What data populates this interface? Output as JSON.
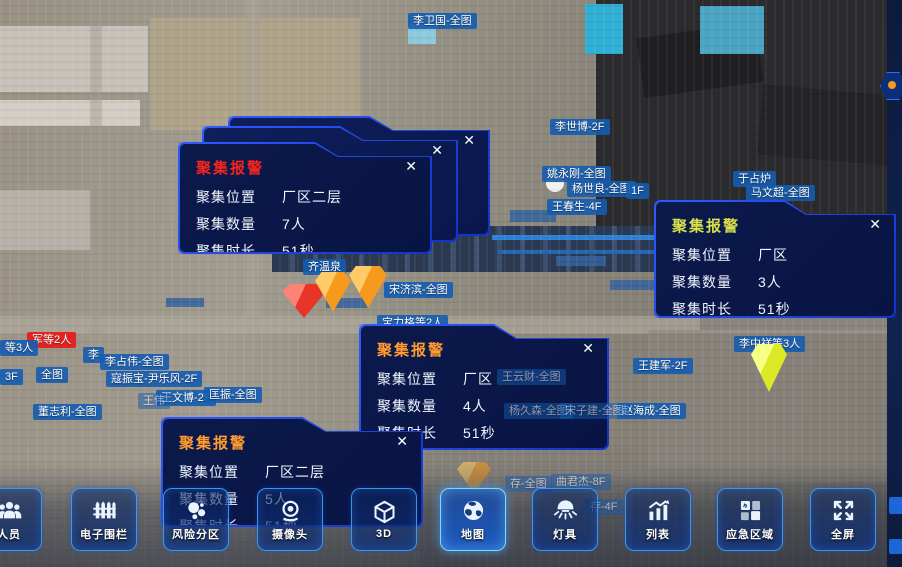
{
  "close_glyph": "✕",
  "colors": {
    "panel_border": "#2d5bff",
    "label_bg": "#155caf",
    "alert_label_bg": "#e41e1e",
    "title_red": "#f5241f",
    "title_orange": "#ff9b2f",
    "title_yellow": "#d7e04a",
    "marker_red": "#e8352a",
    "marker_orange": "#f59a1d",
    "marker_yellow": "#dde926"
  },
  "alarm_panels": [
    {
      "variant": "stack",
      "x": 228,
      "y": 116,
      "w": 262,
      "h": 120,
      "title": "聚集报警",
      "title_color": "#b22a2a",
      "rows": [
        [
          "聚集位置",
          "厂区二层"
        ],
        [
          "聚集数量",
          "5人"
        ],
        [
          "聚集时长",
          "51秒"
        ]
      ]
    },
    {
      "variant": "stack",
      "x": 202,
      "y": 126,
      "w": 256,
      "h": 116,
      "title": "聚集报警",
      "title_color": "#b22a2a",
      "rows": [
        [
          "聚集位置",
          "厂区二层"
        ],
        [
          "聚集数量",
          "5人"
        ],
        [
          "聚集时长",
          "51秒"
        ]
      ]
    },
    {
      "variant": "front",
      "x": 178,
      "y": 142,
      "w": 254,
      "h": 112,
      "title": "聚集报警",
      "title_color": "#f5241f",
      "rows": [
        [
          "聚集位置",
          "厂区二层"
        ],
        [
          "聚集数量",
          "7人"
        ],
        [
          "聚集时长",
          "51秒"
        ]
      ]
    },
    {
      "variant": "front",
      "x": 654,
      "y": 200,
      "w": 242,
      "h": 118,
      "title": "聚集报警",
      "title_color": "#d7e04a",
      "rows": [
        [
          "聚集位置",
          "厂区"
        ],
        [
          "聚集数量",
          "3人"
        ],
        [
          "聚集时长",
          "51秒"
        ]
      ]
    },
    {
      "variant": "front",
      "x": 359,
      "y": 324,
      "w": 250,
      "h": 126,
      "title": "聚集报警",
      "title_color": "#ff9b2f",
      "rows": [
        [
          "聚集位置",
          "厂区"
        ],
        [
          "聚集数量",
          "4人"
        ],
        [
          "聚集时长",
          "51秒"
        ]
      ]
    },
    {
      "variant": "front",
      "x": 161,
      "y": 417,
      "w": 262,
      "h": 110,
      "title": "聚集报警",
      "title_color": "#ff9b2f",
      "rows": [
        [
          "聚集位置",
          "厂区二层"
        ],
        [
          "聚集数量",
          "5人"
        ],
        [
          "聚集时长",
          "51秒"
        ]
      ]
    }
  ],
  "map_labels": [
    {
      "text": "李卫国-全图",
      "x": 408,
      "y": 13
    },
    {
      "text": "李世博-2F",
      "x": 550,
      "y": 119
    },
    {
      "text": "姚永刚-全图",
      "x": 542,
      "y": 166
    },
    {
      "text": "杨世良-全图",
      "x": 567,
      "y": 181
    },
    {
      "text": "1F",
      "x": 626,
      "y": 183
    },
    {
      "text": "王春生-4F",
      "x": 547,
      "y": 199
    },
    {
      "text": "于占炉",
      "x": 733,
      "y": 171
    },
    {
      "text": "马文超-全图",
      "x": 746,
      "y": 185
    },
    {
      "text": "齐温泉",
      "x": 303,
      "y": 259
    },
    {
      "text": "宋济滨-全图",
      "x": 384,
      "y": 282
    },
    {
      "text": "宝力格等2人",
      "x": 377,
      "y": 315
    },
    {
      "text": "军等2人",
      "x": 27,
      "y": 332,
      "variant": "red"
    },
    {
      "text": "等3人",
      "x": 0,
      "y": 340
    },
    {
      "text": "李",
      "x": 83,
      "y": 347
    },
    {
      "text": "李占伟-全图",
      "x": 100,
      "y": 354
    },
    {
      "text": "3F",
      "x": 0,
      "y": 369
    },
    {
      "text": "全图",
      "x": 36,
      "y": 367
    },
    {
      "text": "寇振宝-尹乐风-2F",
      "x": 106,
      "y": 371
    },
    {
      "text": "王伟",
      "x": 138,
      "y": 393,
      "variant": "dim"
    },
    {
      "text": "王文博-2F",
      "x": 156,
      "y": 390
    },
    {
      "text": "匡振-全图",
      "x": 204,
      "y": 387
    },
    {
      "text": "董志利-全图",
      "x": 33,
      "y": 404
    },
    {
      "text": "王建军-2F",
      "x": 633,
      "y": 358
    },
    {
      "text": "李中祥等3人",
      "x": 734,
      "y": 336
    },
    {
      "text": "王云财-全图",
      "x": 497,
      "y": 369,
      "variant": "dim"
    },
    {
      "text": "杨久森-全图",
      "x": 504,
      "y": 403,
      "variant": "dim"
    },
    {
      "text": "宋子建-全图",
      "x": 560,
      "y": 403,
      "variant": "dim"
    },
    {
      "text": "赵海成-全图",
      "x": 617,
      "y": 403
    },
    {
      "text": "存-全图",
      "x": 505,
      "y": 476,
      "variant": "dim"
    },
    {
      "text": "曲君杰-8F",
      "x": 551,
      "y": 474,
      "variant": "dim"
    },
    {
      "text": "存-4F",
      "x": 585,
      "y": 499,
      "variant": "dim"
    }
  ],
  "markers": [
    {
      "color": "red",
      "x": 282,
      "y": 284,
      "w": 44,
      "h": 34
    },
    {
      "color": "orange",
      "x": 315,
      "y": 272,
      "w": 36,
      "h": 40
    },
    {
      "color": "orange",
      "x": 349,
      "y": 266,
      "w": 38,
      "h": 42
    },
    {
      "color": "yellow",
      "x": 751,
      "y": 344,
      "w": 36,
      "h": 48
    },
    {
      "color": "orange",
      "x": 457,
      "y": 462,
      "w": 34,
      "h": 32,
      "variant": "faded"
    }
  ],
  "toolbar": {
    "buttons": [
      {
        "label": "人员",
        "icon": "people-icon",
        "cx": 9
      },
      {
        "label": "电子围栏",
        "icon": "fence-icon",
        "cx": 104
      },
      {
        "label": "风险分区",
        "icon": "risk-icon",
        "cx": 196
      },
      {
        "label": "摄像头",
        "icon": "camera-icon",
        "cx": 290
      },
      {
        "label": "3D",
        "icon": "cube-icon",
        "cx": 384
      },
      {
        "label": "地图",
        "icon": "globe-icon",
        "cx": 473,
        "active": true
      },
      {
        "label": "灯具",
        "icon": "lamp-icon",
        "cx": 565
      },
      {
        "label": "列表",
        "icon": "list-icon",
        "cx": 658
      },
      {
        "label": "应急区域",
        "icon": "emergency-icon",
        "cx": 750
      },
      {
        "label": "全屏",
        "icon": "fullscreen-icon",
        "cx": 843
      }
    ]
  }
}
